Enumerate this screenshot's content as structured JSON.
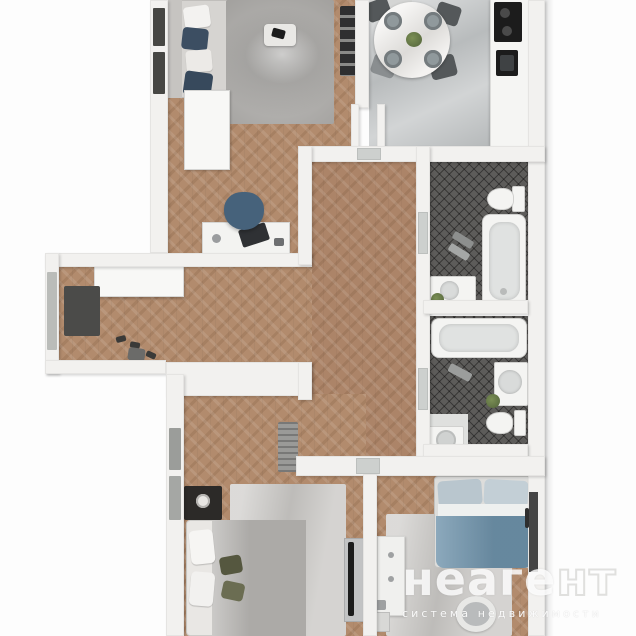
{
  "watermark": {
    "brand_solid": "неаге",
    "brand_outline": "нт",
    "tagline": "система недвижимости"
  },
  "colors": {
    "background": "#fdfdfd",
    "wall": "#f2f1ef",
    "wall_edge": "#d9d8d6",
    "parquet": "#b28b6d",
    "parquet_hall": "#ac8468",
    "floor_marble": "#c3c6c7",
    "tile_dark": "#5d5c5a",
    "rug_marble": "#a9a7a4",
    "rug_light": "#c9c7c4",
    "sofa_gray": "#d6d4d1",
    "pillow_navy": "#3c4e62",
    "chair_blue": "#46627b",
    "chair_dark": "#54585a",
    "blanket_gray": "#b5b3b0",
    "blanket_teal": "#6f93ab",
    "pillow_blue": "#b9c6ce",
    "olive": "#55573f",
    "appliance_black": "#1c1c1c",
    "wood_dark": "#2c2a28",
    "plant_green": "#5e7042",
    "fixture": "#f4f4f2",
    "fixture_inner": "#e0e2e1",
    "watermark_white": "#ffffff"
  }
}
